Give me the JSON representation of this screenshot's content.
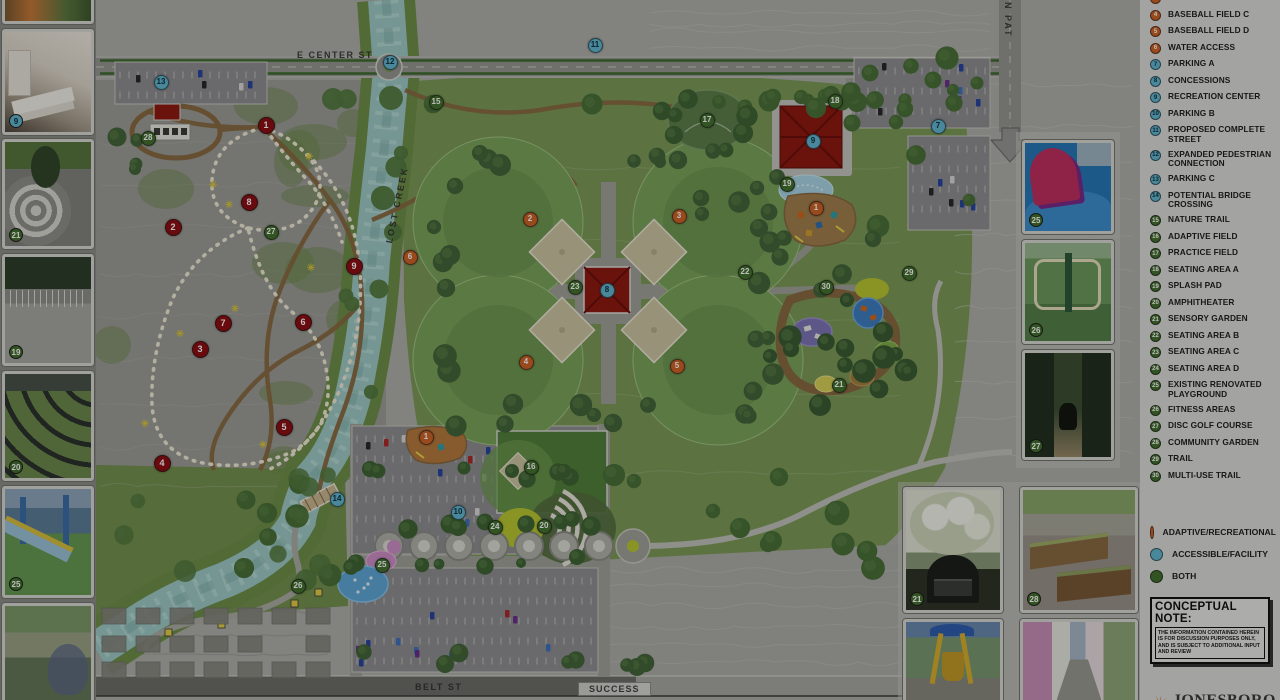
{
  "map": {
    "labels": {
      "e_center_st": "E CENTER ST",
      "lost_creek": "LOST CREEK",
      "n_pat": "N PAT",
      "belt_st": "BELT ST",
      "success": "SUCCESS"
    },
    "marker_colors": {
      "adaptive_recreational": "#cf6428",
      "accessible_facility": "#63b7d2",
      "both": "#44702f",
      "disc_golf_hole": "#8e1014"
    },
    "markers": [
      {
        "n": "11",
        "t": "b",
        "x": 595,
        "y": 45
      },
      {
        "n": "12",
        "t": "b",
        "x": 390,
        "y": 62
      },
      {
        "n": "13",
        "t": "b",
        "x": 161,
        "y": 82
      },
      {
        "n": "28",
        "t": "g",
        "x": 148,
        "y": 138
      },
      {
        "n": "15",
        "t": "g",
        "x": 436,
        "y": 102
      },
      {
        "n": "17",
        "t": "g",
        "x": 707,
        "y": 120
      },
      {
        "n": "18",
        "t": "g",
        "x": 835,
        "y": 101
      },
      {
        "n": "9",
        "t": "b",
        "x": 813,
        "y": 141
      },
      {
        "n": "7",
        "t": "b",
        "x": 938,
        "y": 126
      },
      {
        "n": "19",
        "t": "g",
        "x": 787,
        "y": 184
      },
      {
        "n": "1",
        "t": "o",
        "x": 816,
        "y": 208
      },
      {
        "n": "2",
        "t": "o",
        "x": 530,
        "y": 219
      },
      {
        "n": "3",
        "t": "o",
        "x": 679,
        "y": 216
      },
      {
        "n": "6",
        "t": "o",
        "x": 410,
        "y": 257
      },
      {
        "n": "23",
        "t": "g",
        "x": 575,
        "y": 287
      },
      {
        "n": "8",
        "t": "b",
        "x": 607,
        "y": 290
      },
      {
        "n": "22",
        "t": "g",
        "x": 745,
        "y": 272
      },
      {
        "n": "30",
        "t": "g",
        "x": 826,
        "y": 287
      },
      {
        "n": "29",
        "t": "g",
        "x": 909,
        "y": 273
      },
      {
        "n": "4",
        "t": "o",
        "x": 526,
        "y": 362
      },
      {
        "n": "5",
        "t": "o",
        "x": 677,
        "y": 366
      },
      {
        "n": "21",
        "t": "g",
        "x": 839,
        "y": 385
      },
      {
        "n": "1",
        "t": "o",
        "x": 426,
        "y": 437
      },
      {
        "n": "16",
        "t": "g",
        "x": 531,
        "y": 467
      },
      {
        "n": "14",
        "t": "b",
        "x": 337,
        "y": 499
      },
      {
        "n": "10",
        "t": "b",
        "x": 458,
        "y": 512
      },
      {
        "n": "24",
        "t": "g",
        "x": 495,
        "y": 527
      },
      {
        "n": "20",
        "t": "g",
        "x": 544,
        "y": 526
      },
      {
        "n": "25",
        "t": "g",
        "x": 382,
        "y": 565
      },
      {
        "n": "26",
        "t": "g",
        "x": 298,
        "y": 586
      },
      {
        "n": "27",
        "t": "g",
        "x": 271,
        "y": 232
      },
      {
        "n": "1",
        "t": "r",
        "x": 266,
        "y": 125
      },
      {
        "n": "8",
        "t": "r",
        "x": 249,
        "y": 202
      },
      {
        "n": "2",
        "t": "r",
        "x": 173,
        "y": 227
      },
      {
        "n": "9",
        "t": "r",
        "x": 354,
        "y": 266
      },
      {
        "n": "7",
        "t": "r",
        "x": 223,
        "y": 323
      },
      {
        "n": "6",
        "t": "r",
        "x": 303,
        "y": 322
      },
      {
        "n": "3",
        "t": "r",
        "x": 200,
        "y": 349
      },
      {
        "n": "5",
        "t": "r",
        "x": 284,
        "y": 427
      },
      {
        "n": "4",
        "t": "r",
        "x": 162,
        "y": 463
      }
    ]
  },
  "legend": {
    "items": [
      {
        "num": "3",
        "label": "BASEBALL FIELD B",
        "t": "o",
        "partial": true
      },
      {
        "num": "4",
        "label": "BASEBALL FIELD C",
        "t": "o"
      },
      {
        "num": "5",
        "label": "BASEBALL FIELD D",
        "t": "o"
      },
      {
        "num": "6",
        "label": "WATER ACCESS",
        "t": "o"
      },
      {
        "num": "7",
        "label": "PARKING A",
        "t": "b"
      },
      {
        "num": "8",
        "label": "CONCESSIONS",
        "t": "b"
      },
      {
        "num": "9",
        "label": "RECREATION CENTER",
        "t": "b"
      },
      {
        "num": "10",
        "label": "PARKING B",
        "t": "b"
      },
      {
        "num": "11",
        "label": "PROPOSED COMPLETE STREET",
        "t": "b"
      },
      {
        "num": "12",
        "label": "EXPANDED PEDESTRIAN CONNECTION",
        "t": "b"
      },
      {
        "num": "13",
        "label": "PARKING C",
        "t": "b"
      },
      {
        "num": "14",
        "label": "POTENTIAL BRIDGE CROSSING",
        "t": "b"
      },
      {
        "num": "15",
        "label": "NATURE TRAIL",
        "t": "g"
      },
      {
        "num": "16",
        "label": "ADAPTIVE  FIELD",
        "t": "g"
      },
      {
        "num": "17",
        "label": "PRACTICE FIELD",
        "t": "g"
      },
      {
        "num": "18",
        "label": "SEATING AREA A",
        "t": "g"
      },
      {
        "num": "19",
        "label": "SPLASH PAD",
        "t": "g"
      },
      {
        "num": "20",
        "label": "AMPHITHEATER",
        "t": "g"
      },
      {
        "num": "21",
        "label": "SENSORY GARDEN",
        "t": "g"
      },
      {
        "num": "22",
        "label": "SEATING AREA B",
        "t": "g"
      },
      {
        "num": "23",
        "label": "SEATING AREA C",
        "t": "g"
      },
      {
        "num": "24",
        "label": "SEATING AREA D",
        "t": "g"
      },
      {
        "num": "25",
        "label": "EXISTING RENOVATED PLAYGROUND",
        "t": "g"
      },
      {
        "num": "26",
        "label": "FITNESS AREAS",
        "t": "g"
      },
      {
        "num": "27",
        "label": "DISC GOLF COURSE",
        "t": "g"
      },
      {
        "num": "28",
        "label": "COMMUNITY GARDEN",
        "t": "g"
      },
      {
        "num": "29",
        "label": "TRAIL",
        "t": "g"
      },
      {
        "num": "30",
        "label": "MULTI-USE TRAIL",
        "t": "g"
      }
    ],
    "key": [
      {
        "label": "ADAPTIVE/RECREATIONAL",
        "t": "o"
      },
      {
        "label": "ACCESSIBLE/FACILITY",
        "t": "b"
      },
      {
        "label": "BOTH",
        "t": "g"
      }
    ],
    "note_title": "CONCEPTUAL NOTE:",
    "note_body": "THE INFORMATION CONTAINED HEREIN IS FOR DISCUSSION PURPOSES ONLY, AND IS SUBJECT TO ADDITIONAL INPUT AND REVIEW",
    "logo_text": "JONESBORO",
    "logo_sub": "ARKANSAS"
  },
  "photos": {
    "left": [
      "",
      "9",
      "21",
      "19",
      "20",
      "25",
      ""
    ],
    "right": [
      "25",
      "26",
      "27"
    ],
    "cluster": [
      "21",
      "28",
      "",
      ""
    ]
  }
}
